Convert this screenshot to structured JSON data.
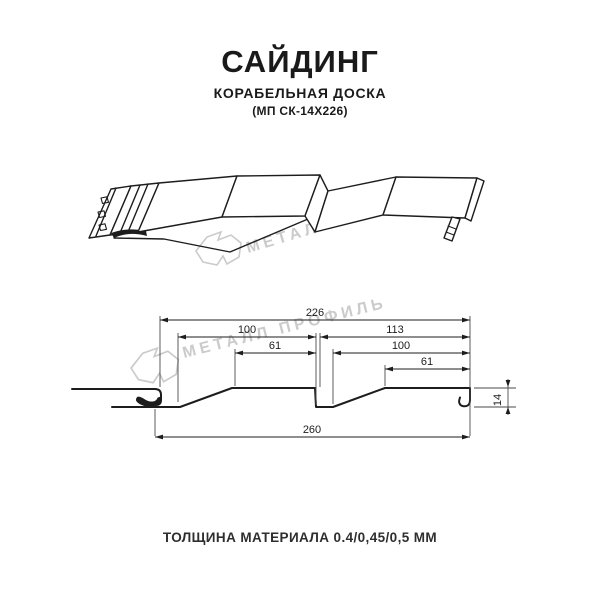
{
  "header": {
    "title": "САЙДИНГ",
    "subtitle": "КОРАБЕЛЬНАЯ ДОСКА",
    "model_code": "(МП СК-14Х226)"
  },
  "watermark": {
    "brand_text": "МЕТАЛЛ ПРОФИЛЬ",
    "logo": "metal-profil-logo",
    "color": "#cbcbcb"
  },
  "section_drawing": {
    "dims": {
      "overall_top": "226",
      "pitch_left": "100",
      "pitch_right": "113",
      "flat_left": "61",
      "flat_right_pitch": "100",
      "flat_right": "61",
      "depth": "14",
      "overall_bottom": "260"
    }
  },
  "footer": {
    "thickness_note": "ТОЛЩИНА МАТЕРИАЛА 0.4/0,45/0,5 ММ"
  },
  "colors": {
    "line": "#1d1d1d",
    "dimension": "#2a2a2a",
    "watermark": "#cbcbcb",
    "background": "#ffffff"
  }
}
